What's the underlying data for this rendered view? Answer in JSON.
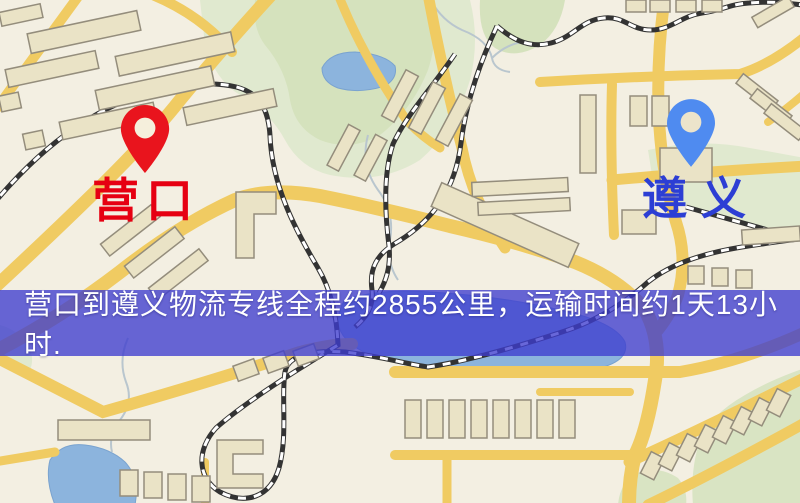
{
  "banner": {
    "text": "营口到遵义物流专线全程约2855公里，运输时间约1天13小时.",
    "background_color": "#3e3cce",
    "text_color": "#ffffff"
  },
  "markers": {
    "origin": {
      "label": "营口",
      "pin_color": "#e9141d",
      "pin_hole_color": "#f5efdc",
      "label_color": "#e60012"
    },
    "destination": {
      "label": "遵义",
      "pin_color": "#4f8bf0",
      "pin_hole_color": "#ece4cb",
      "label_color": "#2c3ed4"
    }
  },
  "map": {
    "colors": {
      "base": "#f3efe2",
      "road": "#f0cb62",
      "building_fill": "#eae3c6",
      "building_outline": "#948d7c",
      "park": "#e0e9cf",
      "park_dark": "#d5e2bd",
      "water": "#8cb4dd",
      "stream": "#b9c6ce",
      "railway_dark": "#333333",
      "railway_light": "#ffffff"
    }
  }
}
